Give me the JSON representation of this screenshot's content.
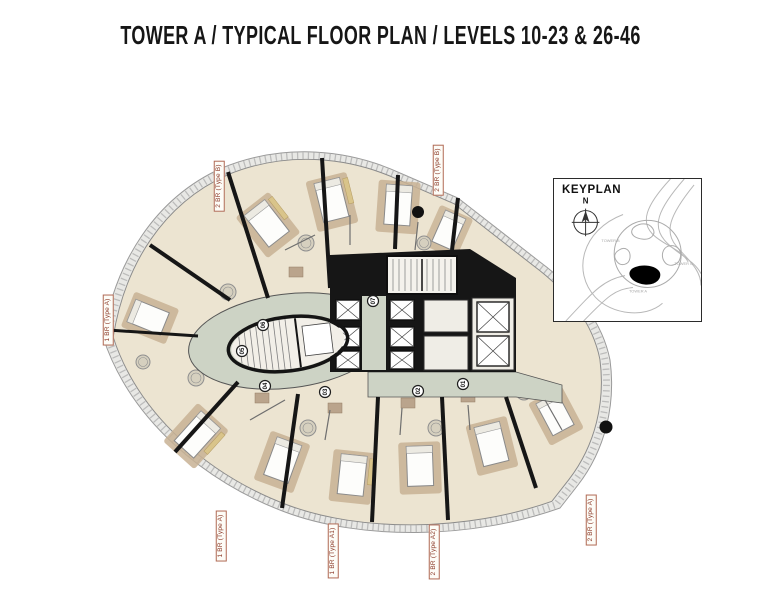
{
  "title": "TOWER A / TYPICAL FLOOR PLAN / LEVELS 10-23 & 26-46",
  "keyplan": {
    "heading": "KEYPLAN",
    "north_label": "N",
    "towers": [
      {
        "name": "TOWER B"
      },
      {
        "name": "TOWER C"
      },
      {
        "name": "TOWER A"
      }
    ],
    "highlighted_tower": "TOWER A"
  },
  "floor_plan": {
    "unit_labels": {
      "top_left": "2 BR (Type B)",
      "top_right": "2 BR (Type B)",
      "left": "1 BR (Type A)",
      "bottom_left": "1 BR (Type A)",
      "bottom_middle": "1 BR (Type A1)",
      "bottom_right": "2 BR (Type A2)",
      "right": "2 BR (Type A)"
    },
    "unit_numbers": [
      "01",
      "02",
      "03",
      "04",
      "05",
      "06",
      "07"
    ]
  },
  "colors": {
    "page_background": "#ffffff",
    "core_black": "#161616",
    "corridor_sage": "#cdd3c5",
    "unit_floor": "#ece4d1",
    "bedroom_carpet": "#c8b294",
    "balcony_gray": "#e8e8e5",
    "bath_tile": "#b59e85",
    "wardrobe_tan": "#d9c48a",
    "label_red_text": "#8c3b2a",
    "label_red_border": "#b06a55",
    "keyplan_line_gray": "#b8b8b8"
  }
}
